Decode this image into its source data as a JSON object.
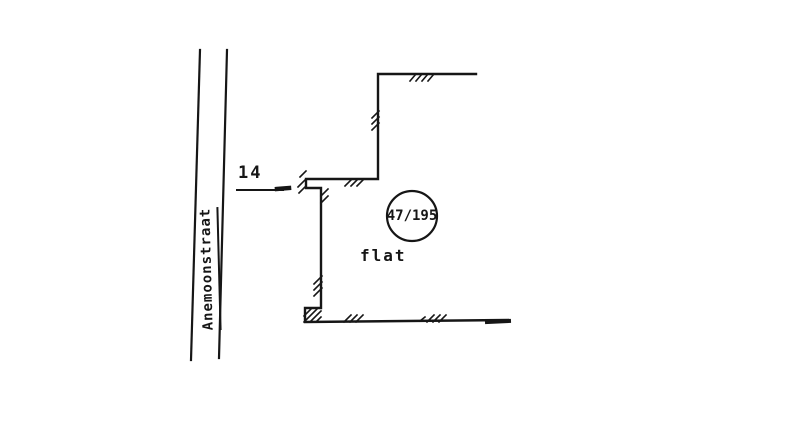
{
  "canvas": {
    "width": 800,
    "height": 423,
    "background": "#ffffff",
    "ink": "#161616"
  },
  "street": {
    "name": "Anemoonstraat",
    "edges": [
      {
        "x1": 200,
        "y1": 50,
        "x2": 191,
        "y2": 360
      },
      {
        "x1": 227,
        "y1": 50,
        "x2": 219,
        "y2": 358
      }
    ]
  },
  "house_number": {
    "text": "14",
    "leader": {
      "x1": 237,
      "y1": 190,
      "x2": 283,
      "y2": 190
    },
    "end_tick": {
      "x1": 277,
      "y1": 189,
      "x2": 289,
      "y2": 188
    }
  },
  "parcel": {
    "circle_label": "47/195",
    "circle": {
      "cx": 412,
      "cy": 216,
      "r": 25
    },
    "building_type": "flat",
    "outline": [
      [
        476,
        74
      ],
      [
        378,
        74
      ],
      [
        378,
        179
      ],
      [
        306,
        179
      ],
      [
        306,
        188
      ],
      [
        321,
        188
      ],
      [
        321,
        308
      ],
      [
        305,
        308
      ],
      [
        305,
        322
      ],
      [
        508,
        320
      ]
    ],
    "bottom_end_tick": {
      "x1": 487,
      "y1": 322,
      "x2": 509,
      "y2": 321
    }
  },
  "hatches": [
    {
      "x1": 410,
      "y1": 81,
      "x2": 416,
      "y2": 74
    },
    {
      "x1": 416,
      "y1": 81,
      "x2": 422,
      "y2": 74
    },
    {
      "x1": 422,
      "y1": 81,
      "x2": 428,
      "y2": 74
    },
    {
      "x1": 428,
      "y1": 81,
      "x2": 434,
      "y2": 74
    },
    {
      "x1": 372,
      "y1": 118,
      "x2": 379,
      "y2": 111
    },
    {
      "x1": 372,
      "y1": 124,
      "x2": 379,
      "y2": 117
    },
    {
      "x1": 372,
      "y1": 130,
      "x2": 379,
      "y2": 123
    },
    {
      "x1": 345,
      "y1": 186,
      "x2": 352,
      "y2": 179
    },
    {
      "x1": 351,
      "y1": 186,
      "x2": 358,
      "y2": 179
    },
    {
      "x1": 357,
      "y1": 186,
      "x2": 364,
      "y2": 179
    },
    {
      "x1": 300,
      "y1": 177,
      "x2": 306,
      "y2": 171
    },
    {
      "x1": 298,
      "y1": 187,
      "x2": 305,
      "y2": 180
    },
    {
      "x1": 299,
      "y1": 193,
      "x2": 306,
      "y2": 186
    },
    {
      "x1": 321,
      "y1": 196,
      "x2": 328,
      "y2": 189
    },
    {
      "x1": 321,
      "y1": 203,
      "x2": 328,
      "y2": 196
    },
    {
      "x1": 314,
      "y1": 284,
      "x2": 322,
      "y2": 276
    },
    {
      "x1": 314,
      "y1": 290,
      "x2": 322,
      "y2": 282
    },
    {
      "x1": 314,
      "y1": 296,
      "x2": 322,
      "y2": 288
    },
    {
      "x1": 304,
      "y1": 316,
      "x2": 312,
      "y2": 308
    },
    {
      "x1": 304,
      "y1": 322,
      "x2": 318,
      "y2": 308
    },
    {
      "x1": 310,
      "y1": 322,
      "x2": 321,
      "y2": 311
    },
    {
      "x1": 316,
      "y1": 322,
      "x2": 321,
      "y2": 317
    },
    {
      "x1": 344,
      "y1": 322,
      "x2": 351,
      "y2": 315
    },
    {
      "x1": 350,
      "y1": 322,
      "x2": 357,
      "y2": 315
    },
    {
      "x1": 356,
      "y1": 322,
      "x2": 363,
      "y2": 315
    },
    {
      "x1": 420,
      "y1": 321,
      "x2": 425,
      "y2": 317
    },
    {
      "x1": 427,
      "y1": 322,
      "x2": 434,
      "y2": 315
    },
    {
      "x1": 433,
      "y1": 322,
      "x2": 440,
      "y2": 315
    },
    {
      "x1": 439,
      "y1": 322,
      "x2": 446,
      "y2": 315
    }
  ]
}
